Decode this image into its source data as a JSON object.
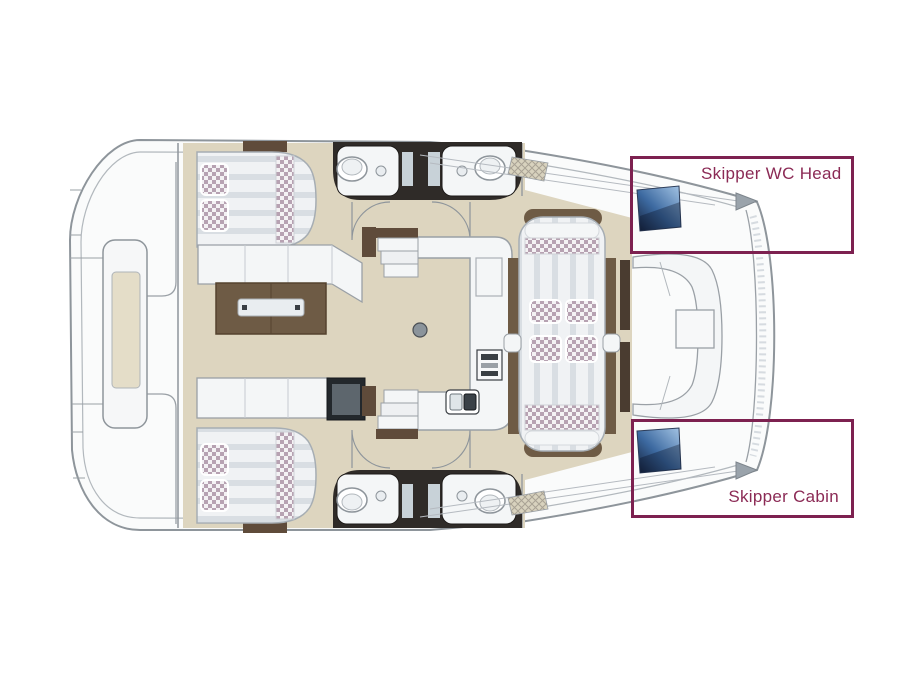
{
  "diagram": {
    "type": "boat-floor-plan",
    "subject": "catamaran deck layout"
  },
  "annotations": {
    "wc_head": {
      "label": "Skipper WC Head"
    },
    "cabin": {
      "label": "Skipper Cabin"
    }
  },
  "colors": {
    "annotation_border": "#7d2150",
    "annotation_text": "#8b2a55",
    "hull_outline": "#8e959b",
    "deck_white": "#fafbfb",
    "floor_beige": "#ddd5bf",
    "wood_brown": "#6e5b45",
    "dark_wall": "#2f2b28",
    "mattress": "#f0f2f4",
    "pillow_checker": "#b7a2b2",
    "berth_cushion_light": "#a6c6e6",
    "berth_cushion_dark": "#141f38"
  }
}
